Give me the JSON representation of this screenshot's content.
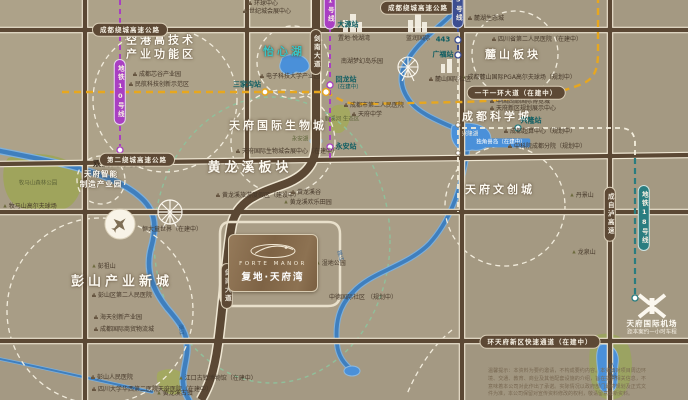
{
  "project": {
    "logo_en": "FORTE MANOR",
    "logo_cn": "复地·天府湾"
  },
  "colors": {
    "background": "#a89d86",
    "road": "#5b4834",
    "road_casing": "#efe7d3",
    "metro_purple": "#a93fc2",
    "metro_navy": "#3d4e91",
    "metro_teal": "#2a7d80",
    "construction_yellow": "#e7a71f",
    "eco_green": "#8fc09b",
    "river": "#3f7fbe",
    "lake": "#4a90d9",
    "park": "#9da558",
    "badge_brown": "#5d4935",
    "title_white": "#fdfaf2",
    "teal_title": "#39c4c6"
  },
  "map_labels": [
    {
      "id": "region-title-konggang",
      "text": "空港高技术\n产业功能区",
      "x": 161,
      "y": 48,
      "cls": "title"
    },
    {
      "id": "item-xingu",
      "text": "成都芯谷产业园",
      "x": 157,
      "y": 75,
      "cls": "item item-b"
    },
    {
      "id": "item-minhang",
      "text": "民航科技创新示范区",
      "x": 159,
      "y": 85,
      "cls": "item item-b"
    },
    {
      "id": "region-title-yixinhu",
      "text": "怡心湖",
      "x": 284,
      "y": 52,
      "cls": "title title-teal"
    },
    {
      "id": "item-dianzikeda",
      "text": "电子科技大学产业园",
      "x": 290,
      "y": 77,
      "cls": "item item-b"
    },
    {
      "id": "region-title-biocity",
      "text": "天府国际生物城",
      "x": 278,
      "y": 126,
      "cls": "title"
    },
    {
      "id": "label-yonganhu",
      "text": "永安湖",
      "x": 300,
      "y": 140,
      "cls": "tiny-dark"
    },
    {
      "id": "item-bio-expo",
      "text": "天府国际生物城会展中心（在建中）",
      "x": 287,
      "y": 152,
      "cls": "item item-b"
    },
    {
      "id": "region-title-huanglongxi",
      "text": "黄龙溪板块",
      "x": 250,
      "y": 169,
      "cls": "title title-lg"
    },
    {
      "id": "item-hlx-resort",
      "text": "黄龙溪旅游度假区（建设中）",
      "x": 258,
      "y": 196,
      "cls": "item item-b"
    },
    {
      "id": "item-hlx-valley",
      "text": "黄龙溪谷",
      "x": 306,
      "y": 193,
      "cls": "item item-b"
    },
    {
      "id": "item-hlx-field",
      "text": "黄龙溪欢乐田园",
      "x": 308,
      "y": 203,
      "cls": "item item-t"
    },
    {
      "id": "item-wetland-park",
      "text": "湿地公园",
      "x": 331,
      "y": 264,
      "cls": "item item-t"
    },
    {
      "id": "item-zhongde",
      "text": "中德国际社区\n（规划中）",
      "x": 363,
      "y": 298,
      "cls": "item"
    },
    {
      "id": "region-title-zhizao",
      "text": "天府智能\n制造产业园",
      "x": 101,
      "y": 179,
      "cls": "title title-sm"
    },
    {
      "id": "label-mumashan-park",
      "text": "牧马山森林公园",
      "x": 38,
      "y": 184,
      "cls": "tiny-dark"
    },
    {
      "id": "item-mumashan-golf",
      "text": "牧马山高尔夫球场",
      "x": 30,
      "y": 207,
      "cls": "item item-t"
    },
    {
      "id": "region-title-pengshan",
      "text": "彭山产业新城",
      "x": 122,
      "y": 283,
      "cls": "title title-lg"
    },
    {
      "id": "item-ps-hospital2",
      "text": "彭山区第二人民医院",
      "x": 122,
      "y": 296,
      "cls": "item item-b"
    },
    {
      "id": "item-haitian",
      "text": "海天创新产业园",
      "x": 118,
      "y": 318,
      "cls": "item item-b"
    },
    {
      "id": "item-wuliucheng",
      "text": "成都国际商贸物流城",
      "x": 124,
      "y": 330,
      "cls": "item item-b"
    },
    {
      "id": "item-ps-hospital",
      "text": "彭山人民医院",
      "x": 112,
      "y": 378,
      "cls": "item item-b"
    },
    {
      "id": "item-huaxi-hospital",
      "text": "四川大学华西第二医院天府医院（在建中）",
      "x": 152,
      "y": 390,
      "cls": "item item-b"
    },
    {
      "id": "item-pengzushan",
      "text": "彭祖山",
      "x": 104,
      "y": 267,
      "cls": "item item-t"
    },
    {
      "id": "item-hlx-town",
      "text": "黄龙溪古镇",
      "x": 175,
      "y": 394,
      "cls": "item item-t"
    },
    {
      "id": "item-jiangkou",
      "text": "江口古镇博物馆（在建中）",
      "x": 218,
      "y": 379,
      "cls": "item item-t"
    },
    {
      "id": "item-hengda",
      "text": "恒大童世界（在建中）",
      "x": 172,
      "y": 230,
      "cls": "item"
    },
    {
      "id": "region-title-lushan",
      "text": "麓山板块",
      "x": 513,
      "y": 55,
      "cls": "title"
    },
    {
      "id": "item-sc2-hospital",
      "text": "四川省第二人民医院（在建中）",
      "x": 537,
      "y": 40,
      "cls": "item item-b"
    },
    {
      "id": "item-pga-golf",
      "text": "成都麓山国际PGA高尔夫球场（规划中）",
      "x": 519,
      "y": 78,
      "cls": "item item-t"
    },
    {
      "id": "item-luhu",
      "text": "麓湖生态城",
      "x": 486,
      "y": 19,
      "cls": "item item-b"
    },
    {
      "id": "item-lushan-guoji",
      "text": "麓山国际社区",
      "x": 450,
      "y": 80,
      "cls": "item item-b"
    },
    {
      "id": "region-title-kexuecheng",
      "text": "成都科学城",
      "x": 497,
      "y": 117,
      "cls": "title"
    },
    {
      "id": "item-expo-city",
      "text": "中国西部国际博览城",
      "x": 520,
      "y": 102,
      "cls": "item item-b"
    },
    {
      "id": "item-guihua-hall",
      "text": "天府新区规划展示中心",
      "x": 523,
      "y": 109,
      "cls": "item item-b"
    },
    {
      "id": "label-xinglonghu",
      "text": "兴隆湖",
      "x": 470,
      "y": 135,
      "cls": "tiny-white"
    },
    {
      "id": "tag-unicorn-island",
      "text": "独角兽岛（在建中）",
      "x": 501,
      "y": 143,
      "cls": "tag-blue"
    },
    {
      "id": "item-chaosuan",
      "text": "成都超算中心（规划中）",
      "x": 540,
      "y": 132,
      "cls": "item item-b"
    },
    {
      "id": "item-zhongkeyuan",
      "text": "中科院成都分院（规划中）",
      "x": 547,
      "y": 147,
      "cls": "item item-b"
    },
    {
      "id": "region-title-wenchuang",
      "text": "天府文创城",
      "x": 500,
      "y": 190,
      "cls": "title"
    },
    {
      "id": "item-danjingshan",
      "text": "丹景山",
      "x": 582,
      "y": 196,
      "cls": "item item-t"
    },
    {
      "id": "item-longquanshan",
      "text": "龙泉山",
      "x": 584,
      "y": 253,
      "cls": "item item-t"
    },
    {
      "id": "label-sanchahu",
      "text": "三岔湖",
      "x": 611,
      "y": 371,
      "cls": "tiny-blue",
      "rot": 75
    },
    {
      "id": "label-shuangliu-airport",
      "text": "双流国际机场",
      "x": 120,
      "y": 164,
      "cls": "airport-label"
    },
    {
      "id": "label-tianfu-airport",
      "text": "天府国际机场",
      "x": 652,
      "y": 324,
      "cls": "white-label"
    },
    {
      "id": "label-tianfu-airport-sub",
      "text": "距本案约一小时车程",
      "x": 652,
      "y": 333,
      "cls": "tiny-white"
    },
    {
      "id": "station-dayuan",
      "text": "大源站",
      "x": 348,
      "y": 25,
      "cls": "station"
    },
    {
      "id": "station-huilong",
      "text": "回龙站",
      "x": 346,
      "y": 80,
      "cls": "station"
    },
    {
      "id": "station-huilong-sub",
      "text": "（在建中）",
      "x": 348,
      "y": 88,
      "cls": "station-sub"
    },
    {
      "id": "station-yongan",
      "text": "永安站",
      "x": 346,
      "y": 147,
      "cls": "station"
    },
    {
      "id": "station-sanjiagou",
      "text": "三家沟站",
      "x": 247,
      "y": 85,
      "cls": "station"
    },
    {
      "id": "station-huayang",
      "text": "443",
      "x": 443,
      "y": 40,
      "cls": "station"
    },
    {
      "id": "station-guangfu",
      "text": "广福站",
      "x": 443,
      "y": 55,
      "cls": "station"
    },
    {
      "id": "station-xinglong",
      "text": "兴隆站",
      "x": 531,
      "y": 121,
      "cls": "station"
    },
    {
      "id": "road-badge-raocheng",
      "text": "成都绕城高速公路",
      "x": 130,
      "y": 30,
      "cls": "badge"
    },
    {
      "id": "road-badge-raocheng-2",
      "text": "成都绕城高速公路",
      "x": 418,
      "y": 8,
      "cls": "badge"
    },
    {
      "id": "road-badge-errao",
      "text": "第二绕城高速公路",
      "x": 137,
      "y": 160,
      "cls": "badge"
    },
    {
      "id": "road-badge-huantianfu",
      "text": "环天府新区快速通道（在建中）",
      "x": 540,
      "y": 342,
      "cls": "badge"
    },
    {
      "id": "road-badge-yiganyihuan",
      "text": "一干一环大道（在建中）",
      "x": 516,
      "y": 93,
      "cls": "badge"
    },
    {
      "id": "road-badge-jiannan",
      "text": "剑南大道",
      "x": 316,
      "y": 52,
      "cls": "vbadge"
    },
    {
      "id": "road-badge-jiannan-south",
      "text": "剑南大道",
      "x": 227,
      "y": 286,
      "cls": "vbadge"
    },
    {
      "id": "road-badge-chengzilu",
      "text": "成自泸高速",
      "x": 610,
      "y": 214,
      "cls": "vbadge"
    },
    {
      "id": "metro-badge-line10",
      "text": "地铁10号线",
      "x": 120,
      "y": 92,
      "cls": "vbadge vbadge-purple"
    },
    {
      "id": "metro-badge-line1",
      "text": "1号线",
      "x": 330,
      "y": 10,
      "cls": "vbadge vbadge-purple"
    },
    {
      "id": "metro-badge-line5",
      "text": "5号线",
      "x": 458,
      "y": 9,
      "cls": "vbadge vbadge-navy"
    },
    {
      "id": "metro-badge-line18",
      "text": "地铁18号线",
      "x": 644,
      "y": 218,
      "cls": "vbadge vbadge-teal"
    },
    {
      "id": "item-huanqiu",
      "text": "环球中心",
      "x": 263,
      "y": 4,
      "cls": "item item-b"
    },
    {
      "id": "item-shijicheng",
      "text": "世纪城会展中心",
      "x": 267,
      "y": 12,
      "cls": "item item-b"
    },
    {
      "id": "item-bld-yuehuwan",
      "text": "置地·悦湖湾",
      "x": 354,
      "y": 39,
      "cls": "item"
    },
    {
      "id": "item-bld-lanrun",
      "text": "蓝润国际",
      "x": 418,
      "y": 39,
      "cls": "item"
    },
    {
      "id": "item-nanhu-park",
      "text": "南湖梦幻岛乐园",
      "x": 362,
      "y": 62,
      "cls": "item"
    },
    {
      "id": "item-cd2-hospital",
      "text": "成都市第二人民医院",
      "x": 374,
      "y": 106,
      "cls": "item item-b"
    },
    {
      "id": "item-tianfu-school",
      "text": "天府中学",
      "x": 367,
      "y": 115,
      "cls": "item item-b"
    },
    {
      "id": "label-luxihe",
      "text": "鹿溪河\n生态区",
      "x": 342,
      "y": 120,
      "cls": "tiny-dark"
    },
    {
      "id": "label-jinjiang-river",
      "text": "锦江",
      "x": 339,
      "y": 256,
      "cls": "tiny-blue",
      "rot": 75
    },
    {
      "id": "label-minjiang-river",
      "text": "岷江",
      "x": 180,
      "y": 330,
      "cls": "tiny-blue",
      "rot": 85
    }
  ],
  "disclaimer": "温馨提示：本资料为要约邀请，不构成要约内容。本资料对项目周边环境、交通、教育、商业及其他配套设施的介绍，旨在提供相关信息，不意味着本公司对此作出了承诺。实际情况以政府部门最终规划及正式文件为准，本公司保留对宣传资料修改的权利，敬请留意最新资料。"
}
